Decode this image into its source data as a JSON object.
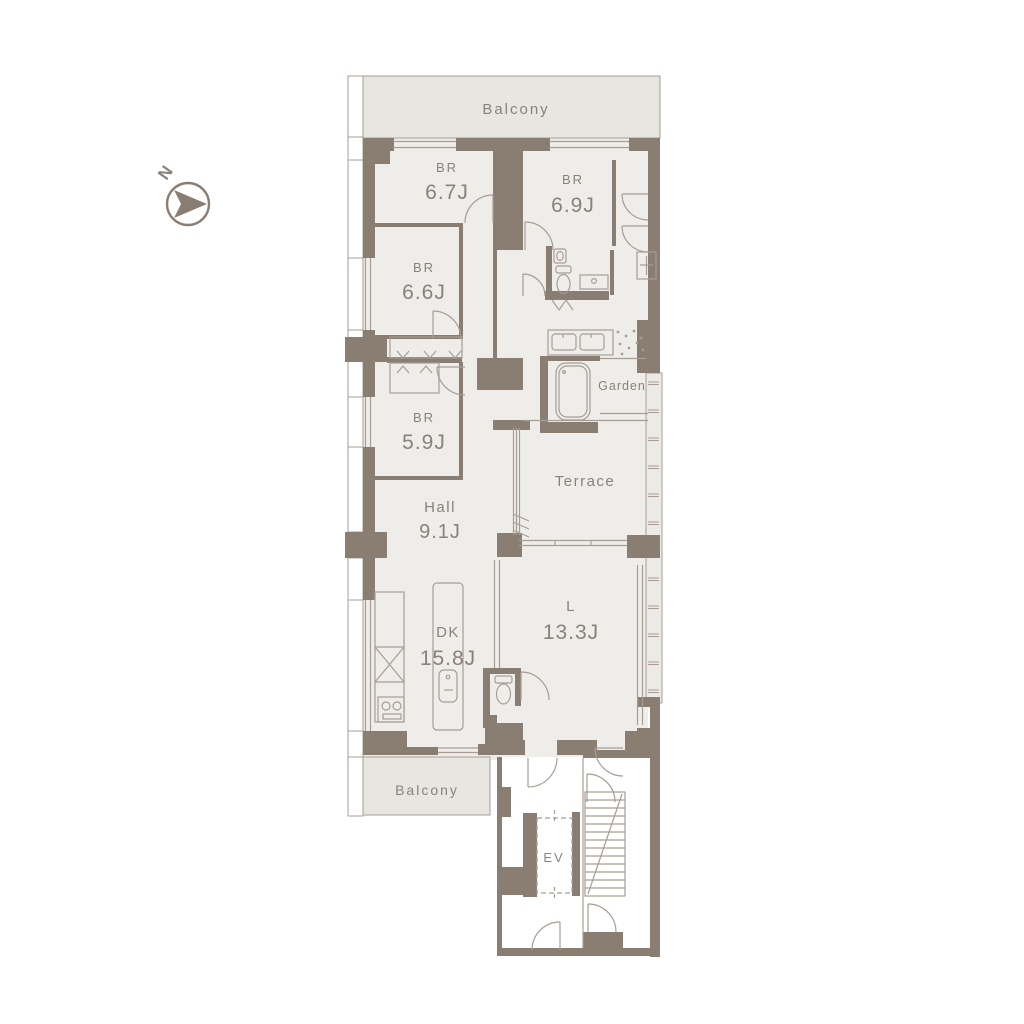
{
  "colors": {
    "wall": "#8a7d72",
    "room_fill": "#efede9",
    "balcony_fill": "#e8e6e1",
    "outline": "#a79d94",
    "label_text": "#8a827a",
    "background": "#ffffff"
  },
  "compass": {
    "label": "N"
  },
  "rooms": {
    "balcony_top": {
      "label": "Balcony"
    },
    "br_67": {
      "name": "BR",
      "area": "6.7J"
    },
    "br_69": {
      "name": "BR",
      "area": "6.9J"
    },
    "br_66": {
      "name": "BR",
      "area": "6.6J"
    },
    "br_59": {
      "name": "BR",
      "area": "5.9J"
    },
    "garden": {
      "label": "Garden"
    },
    "terrace": {
      "label": "Terrace"
    },
    "hall": {
      "name": "Hall",
      "area": "9.1J"
    },
    "dk": {
      "name": "DK",
      "area": "15.8J"
    },
    "living": {
      "name": "L",
      "area": "13.3J"
    },
    "balcony_bottom": {
      "label": "Balcony"
    },
    "elevator": {
      "label": "EV"
    }
  }
}
